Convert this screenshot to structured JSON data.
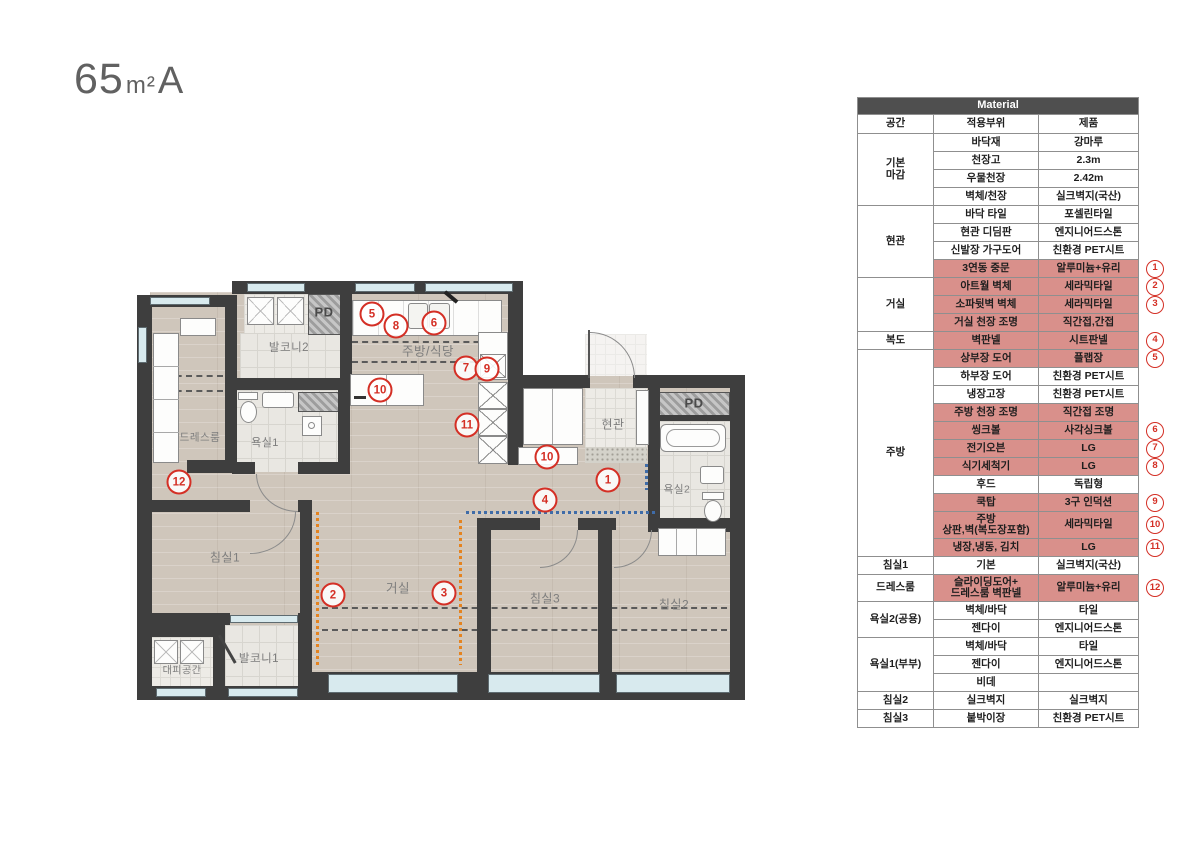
{
  "title": {
    "area": "65",
    "unit": "m²",
    "plan_type": "A"
  },
  "colors": {
    "highlight": "#d9908b",
    "marker_red": "#d42f25",
    "wall": "#3e3e3e"
  },
  "materials": {
    "header": "Material",
    "columns": [
      "공간",
      "적용부위",
      "제품"
    ],
    "groups": [
      {
        "space": "기본\n마감",
        "rows": [
          {
            "part": "바닥재",
            "product": "강마루"
          },
          {
            "part": "천장고",
            "product": "2.3m"
          },
          {
            "part": "우물천장",
            "product": "2.42m"
          },
          {
            "part": "벽체/천장",
            "product": "실크벽지(국산)"
          }
        ]
      },
      {
        "space": "현관",
        "rows": [
          {
            "part": "바닥 타일",
            "product": "포셀린타일"
          },
          {
            "part": "현관 디딤판",
            "product": "엔지니어드스톤"
          },
          {
            "part": "신발장 가구도어",
            "product": "친환경 PET시트"
          },
          {
            "part": "3연동 중문",
            "product": "알루미늄+유리",
            "pink": true,
            "num": "1"
          }
        ]
      },
      {
        "space": "거실",
        "rows": [
          {
            "part": "아트월 벽체",
            "product": "세라믹타일",
            "pink": true,
            "num": "2"
          },
          {
            "part": "소파뒷벽 벽체",
            "product": "세라믹타일",
            "pink": true,
            "num": "3"
          },
          {
            "part": "거실 천장 조명",
            "product": "직간접,간접",
            "pink": true
          }
        ]
      },
      {
        "space": "복도",
        "rows": [
          {
            "part": "벽판넬",
            "product": "시트판넬",
            "pink": true,
            "num": "4"
          }
        ]
      },
      {
        "space": "주방",
        "rows": [
          {
            "part": "상부장 도어",
            "product": "플랩장",
            "pink": true,
            "num": "5"
          },
          {
            "part": "하부장 도어",
            "product": "친환경 PET시트"
          },
          {
            "part": "냉장고장",
            "product": "친환경 PET시트"
          },
          {
            "part": "주방 천장 조명",
            "product": "직간접 조명",
            "pink": true
          },
          {
            "part": "씽크볼",
            "product": "사각싱크볼",
            "pink": true,
            "num": "6"
          },
          {
            "part": "전기오븐",
            "product": "LG",
            "pink": true,
            "num": "7"
          },
          {
            "part": "식기세척기",
            "product": "LG",
            "pink": true,
            "num": "8"
          },
          {
            "part": "후드",
            "product": "독립형"
          },
          {
            "part": "쿡탑",
            "product": "3구 인덕션",
            "pink": true,
            "num": "9"
          },
          {
            "part": "주방\n상판,벽(복도장포함)",
            "product": "세라믹타일",
            "pink": true,
            "num": "10",
            "tall": true
          },
          {
            "part": "냉장,냉동, 김치",
            "product": "LG",
            "pink": true,
            "num": "11"
          }
        ]
      },
      {
        "space": "침실1",
        "rows": [
          {
            "part": "기본",
            "product": "실크벽지(국산)"
          }
        ]
      },
      {
        "space": "드레스룸",
        "rows": [
          {
            "part": "슬라이딩도어+\n드레스룸 벽판넬",
            "product": "알루미늄+유리",
            "pink": true,
            "num": "12",
            "tall": true
          }
        ]
      },
      {
        "space": "욕실2(공용)",
        "rows": [
          {
            "part": "벽체/바닥",
            "product": "타일"
          },
          {
            "part": "젠다이",
            "product": "엔지니어드스톤"
          }
        ]
      },
      {
        "space": "욕실1(부부)",
        "rows": [
          {
            "part": "벽체/바닥",
            "product": "타일"
          },
          {
            "part": "젠다이",
            "product": "엔지니어드스톤"
          },
          {
            "part": "비데",
            "product": ""
          }
        ]
      },
      {
        "space": "침실2",
        "rows": [
          {
            "part": "실크벽지",
            "product": "실크벽지"
          }
        ]
      },
      {
        "space": "침실3",
        "rows": [
          {
            "part": "붙박이장",
            "product": "친환경 PET시트"
          }
        ]
      }
    ]
  },
  "plan": {
    "labels": [
      {
        "id": "balcony2",
        "text": "발코니2",
        "x": 289,
        "y": 347,
        "fs": 11.5
      },
      {
        "id": "pd-left",
        "text": "PD",
        "x": 324,
        "y": 312,
        "fs": 13,
        "c": "#4a4a4a",
        "b": 1
      },
      {
        "id": "kitchen-dining",
        "text": "주방/식당",
        "x": 428,
        "y": 350,
        "fs": 12.5
      },
      {
        "id": "dressroom",
        "text": "드레스룸",
        "x": 200,
        "y": 437,
        "fs": 10.5
      },
      {
        "id": "bath1",
        "text": "욕실1",
        "x": 265,
        "y": 442,
        "fs": 11
      },
      {
        "id": "entrance",
        "text": "현관",
        "x": 613,
        "y": 424,
        "fs": 12
      },
      {
        "id": "pd-right",
        "text": "PD",
        "x": 694,
        "y": 403,
        "fs": 13,
        "c": "#4a4a4a",
        "b": 1
      },
      {
        "id": "bath2",
        "text": "욕실2",
        "x": 677,
        "y": 489,
        "fs": 10.5
      },
      {
        "id": "bedroom1",
        "text": "침실1",
        "x": 225,
        "y": 557,
        "fs": 12
      },
      {
        "id": "living",
        "text": "거실",
        "x": 398,
        "y": 587,
        "fs": 12.5
      },
      {
        "id": "evac",
        "text": "대피공간",
        "x": 182,
        "y": 669,
        "fs": 10
      },
      {
        "id": "balcony1",
        "text": "발코니1",
        "x": 259,
        "y": 658,
        "fs": 11.5
      },
      {
        "id": "bedroom3",
        "text": "침실3",
        "x": 545,
        "y": 598,
        "fs": 12
      },
      {
        "id": "bedroom2",
        "text": "침실2",
        "x": 674,
        "y": 604,
        "fs": 12
      }
    ],
    "markers": [
      {
        "n": "5",
        "x": 372,
        "y": 314
      },
      {
        "n": "8",
        "x": 396,
        "y": 326
      },
      {
        "n": "6",
        "x": 434,
        "y": 323
      },
      {
        "n": "7",
        "x": 466,
        "y": 368
      },
      {
        "n": "9",
        "x": 487,
        "y": 369
      },
      {
        "n": "10",
        "x": 380,
        "y": 390
      },
      {
        "n": "11",
        "x": 467,
        "y": 425
      },
      {
        "n": "10",
        "x": 547,
        "y": 457
      },
      {
        "n": "1",
        "x": 608,
        "y": 480
      },
      {
        "n": "4",
        "x": 545,
        "y": 500
      },
      {
        "n": "12",
        "x": 179,
        "y": 482
      },
      {
        "n": "2",
        "x": 333,
        "y": 595
      },
      {
        "n": "3",
        "x": 444,
        "y": 593
      }
    ]
  }
}
